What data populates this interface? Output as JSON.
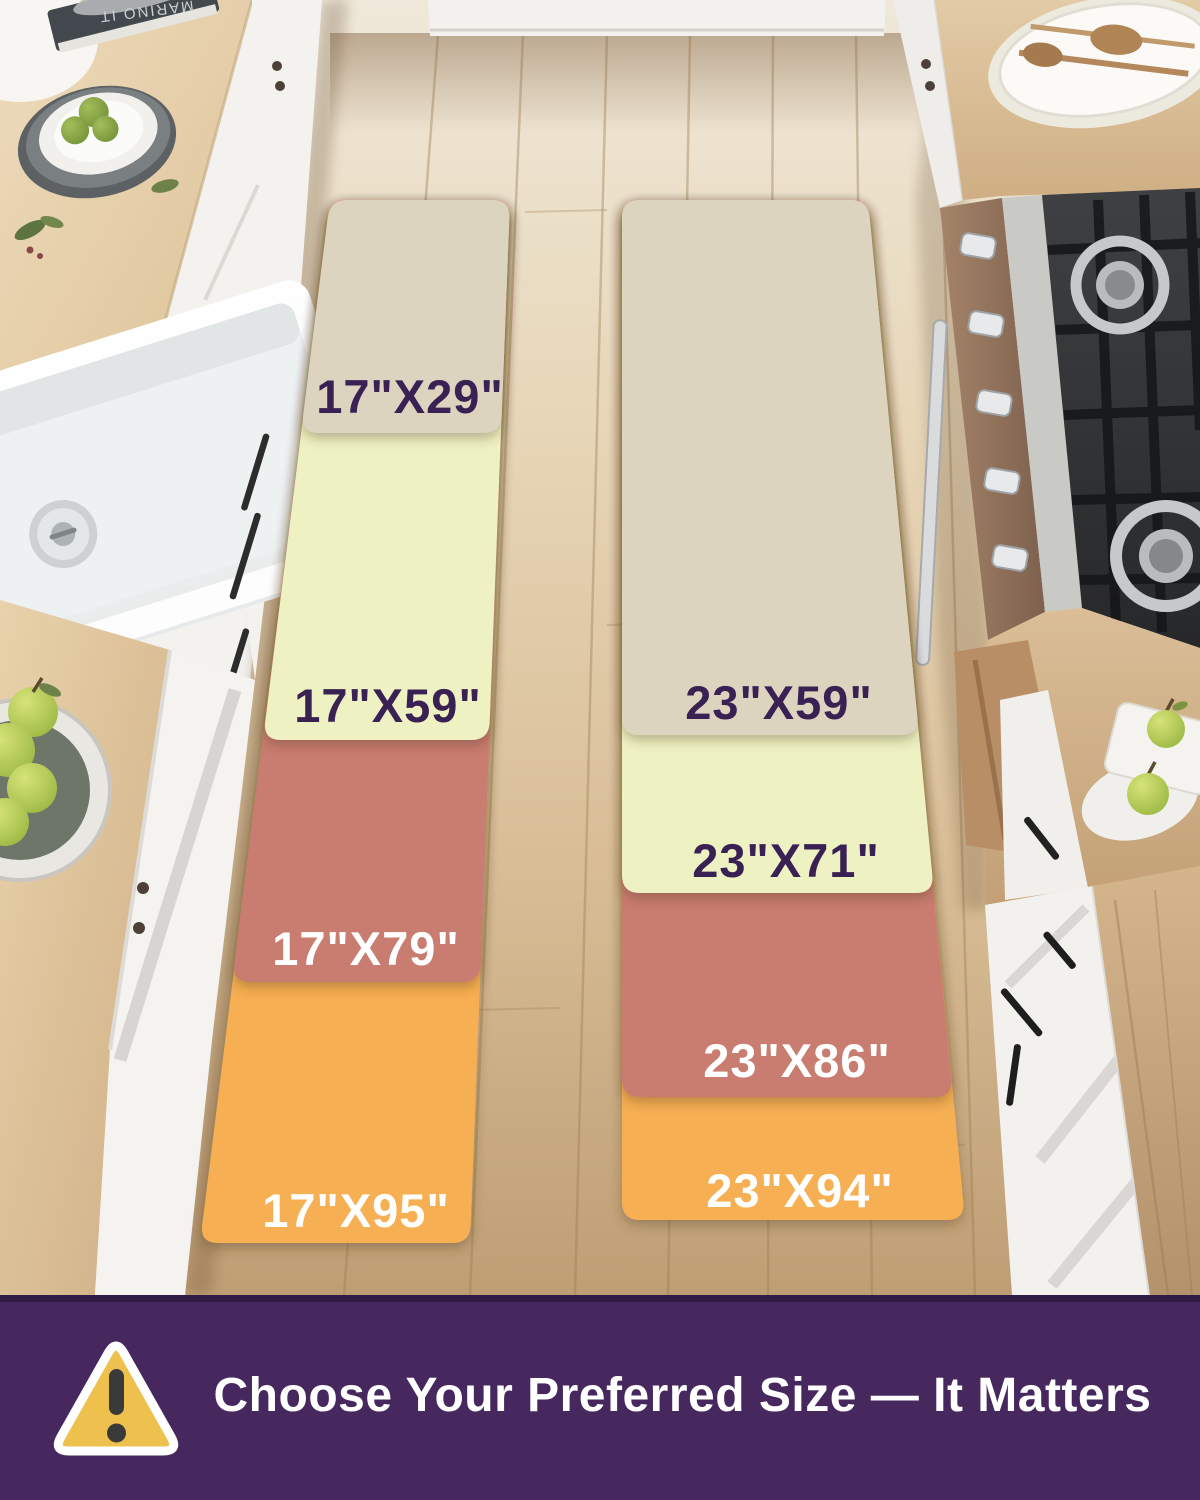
{
  "size_guide": {
    "left_column": {
      "mats": [
        {
          "label": "17\"X29\"",
          "color": "#ddd4bf",
          "label_color": "#3a2154"
        },
        {
          "label": "17\"X59\"",
          "color": "#eef2c3",
          "label_color": "#3a2154"
        },
        {
          "label": "17\"X79\"",
          "color": "#c97b6f",
          "label_color": "#ffffff"
        },
        {
          "label": "17\"X95\"",
          "color": "#f7af53",
          "label_color": "#ffffff"
        }
      ]
    },
    "right_column": {
      "mats": [
        {
          "label": "23\"X59\"",
          "color": "#ddd4bf",
          "label_color": "#3a2154"
        },
        {
          "label": "23\"X71\"",
          "color": "#eef2c3",
          "label_color": "#3a2154"
        },
        {
          "label": "23\"X86\"",
          "color": "#c97b6f",
          "label_color": "#ffffff"
        },
        {
          "label": "23\"X94\"",
          "color": "#f7af53",
          "label_color": "#ffffff"
        }
      ]
    }
  },
  "banner": {
    "text": "Choose Your Preferred Size — It Matters",
    "bg_color": "#46285e",
    "text_color": "#ffffff",
    "warning_icon": {
      "fill": "#eec04e",
      "mark_color": "#3a3a3a"
    }
  },
  "props": {
    "book_spine_text": "MARINO IT"
  }
}
